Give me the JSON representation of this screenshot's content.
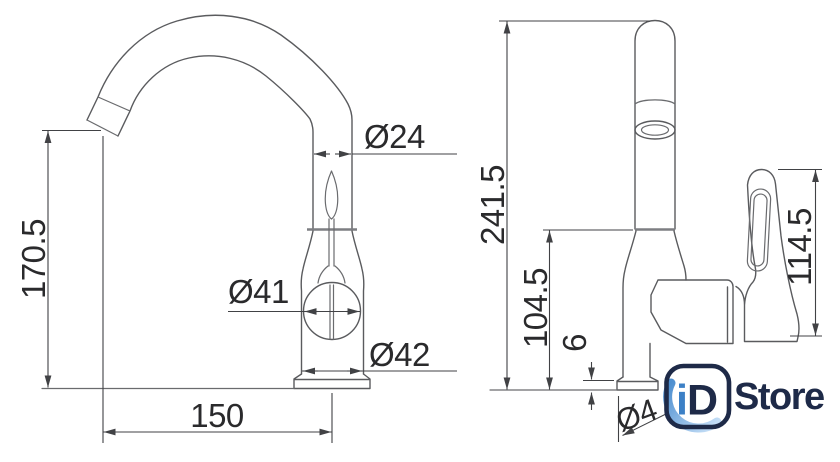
{
  "drawing_title": "faucet technical dimension drawing",
  "front_view": {
    "spout_height": "170.5",
    "spout_reach": "150",
    "spout_tube_diameter": "Ø24",
    "body_diameter": "Ø41",
    "base_diameter": "Ø42"
  },
  "side_view": {
    "total_height": "241.5",
    "body_height": "104.5",
    "base_plate_height": "6",
    "handle_height": "114.5",
    "base_diameter_partial": "Ø4"
  },
  "logo": {
    "letter_i": "i",
    "letter_d": "D",
    "word": "Store",
    "navy": "#1e2a48",
    "blue": "#3c80c6",
    "swoosh_dark": "#4e8fd0",
    "swoosh_light": "#c3ddf6"
  },
  "colors": {
    "background": "#ffffff",
    "outline": "#5a5b5e",
    "dimension_line": "#414245",
    "dimension_text": "#2a2a2c"
  }
}
